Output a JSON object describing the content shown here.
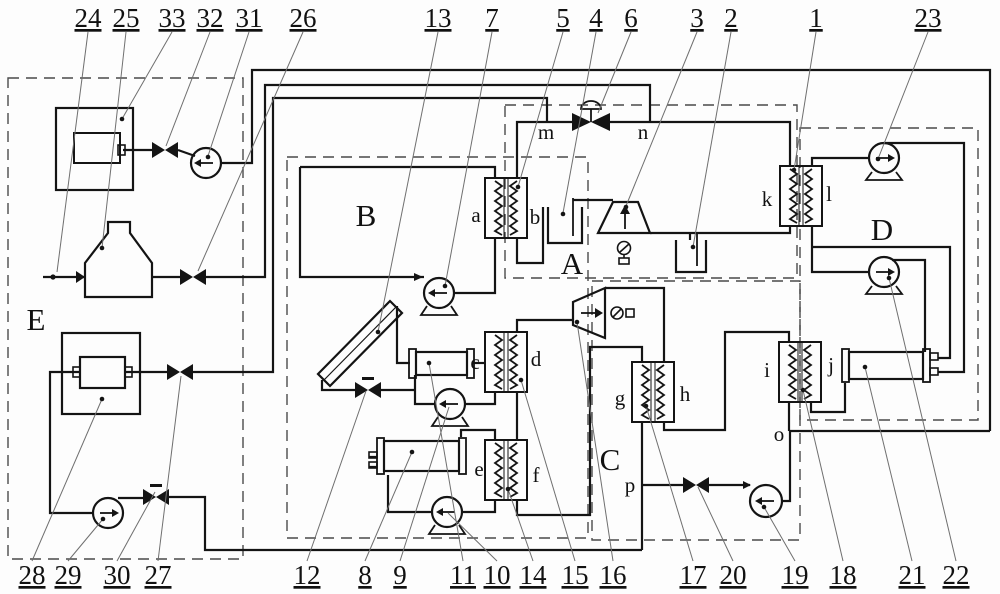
{
  "diagram": {
    "part_numbers": {
      "n1": "1",
      "n2": "2",
      "n3": "3",
      "n4": "4",
      "n5": "5",
      "n6": "6",
      "n7": "7",
      "n8": "8",
      "n9": "9",
      "n10": "10",
      "n11": "11",
      "n12": "12",
      "n13": "13",
      "n14": "14",
      "n15": "15",
      "n16": "16",
      "n17": "17",
      "n18": "18",
      "n19": "19",
      "n20": "20",
      "n21": "21",
      "n22": "22",
      "n23": "23",
      "n24": "24",
      "n25": "25",
      "n26": "26",
      "n27": "27",
      "n28": "28",
      "n29": "29",
      "n30": "30",
      "n31": "31",
      "n32": "32",
      "n33": "33"
    },
    "region_labels": {
      "A": "A",
      "B": "B",
      "C": "C",
      "D": "D",
      "E": "E"
    },
    "port_labels": {
      "a": "a",
      "b": "b",
      "c": "c",
      "d": "d",
      "e": "e",
      "f": "f",
      "g": "g",
      "h": "h",
      "i": "i",
      "j": "j",
      "k": "k",
      "l": "l",
      "m": "m",
      "n": "n",
      "o": "o",
      "p": "p"
    }
  },
  "colors": {
    "line": "#141414",
    "leader": "#6f6f6f",
    "dash": "#4a4a4a",
    "background": "#fdfdfd"
  }
}
